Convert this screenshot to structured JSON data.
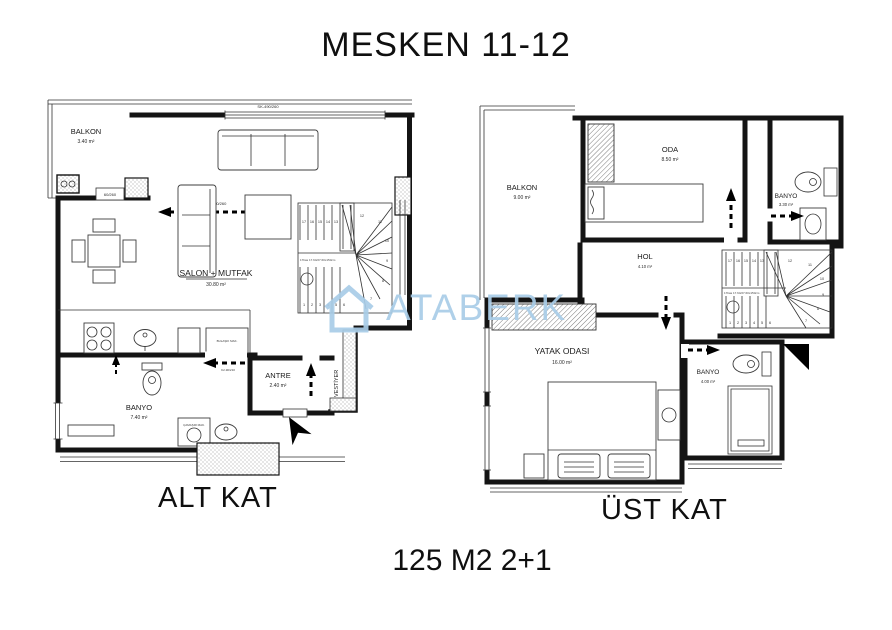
{
  "title": "MESKEN 11-12",
  "area_label": "125 M2 2+1",
  "watermark": "ATABERK",
  "alt": {
    "floor_label": "ALT KAT",
    "balkon_name": "BALKON",
    "balkon_area": "3.40 m²",
    "salon_name": "SALON + MUTFAK",
    "salon_area": "30.80 m²",
    "banyo_name": "BANYO",
    "banyo_area": "7.40 m²",
    "antre_name": "ANTRE",
    "antre_area": "2.40 m²",
    "vestiyer": "VESTİYER",
    "win_top": "SK-490/260",
    "door_balkon": "K3-180/260",
    "door_small": "60/260",
    "door_banyo": "K2-90/210",
    "dishwasher": "BULAŞIK MAK.",
    "washer": "ÇAMAŞIR MAK.",
    "stair_note": "17bas 17.64/27.60x150cm"
  },
  "ust": {
    "floor_label": "ÜST KAT",
    "balkon_name": "BALKON",
    "balkon_area": "9.00 m²",
    "oda_name": "ODA",
    "oda_area": "8.50 m²",
    "banyo1_name": "BANYO",
    "banyo1_area": "3.30 m²",
    "hol_name": "HOL",
    "hol_area": "4.10 m²",
    "yatak_name": "YATAK ODASI",
    "yatak_area": "16.00 m²",
    "banyo2_name": "BANYO",
    "banyo2_area": "4.00 m²",
    "stair_note": "17bas 17.64/27.60x150cm"
  },
  "stairs": {
    "steps_top": [
      "17",
      "16",
      "15",
      "14",
      "13"
    ],
    "steps_fan": [
      "12",
      "11",
      "10",
      "9",
      "8",
      "7"
    ],
    "steps_bottom": [
      "1",
      "2",
      "3",
      "4",
      "5",
      "6"
    ]
  }
}
